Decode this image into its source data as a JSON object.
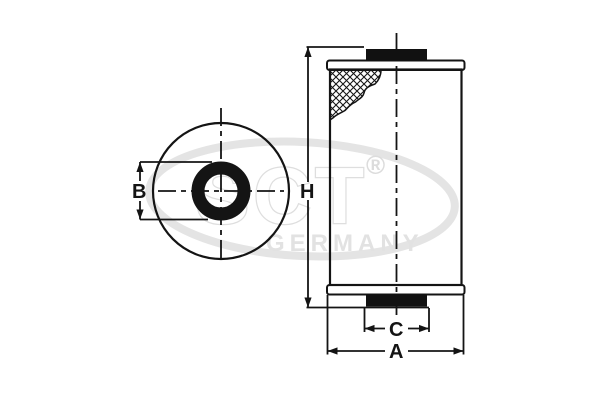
{
  "diagram": {
    "kind": "technical-drawing-oil-filter-element",
    "dimension_labels": {
      "overall_height": "H",
      "inner_bore_diameter": "B",
      "seal_diameter": "C",
      "outer_diameter": "A"
    }
  },
  "watermark": {
    "brand": "SCT",
    "registered_mark": "®",
    "country": "GERMANY"
  },
  "colors": {
    "background": "#ffffff",
    "line": "#141414",
    "seal_fill": "#111111",
    "watermark_gray": "#e2e2e2"
  }
}
